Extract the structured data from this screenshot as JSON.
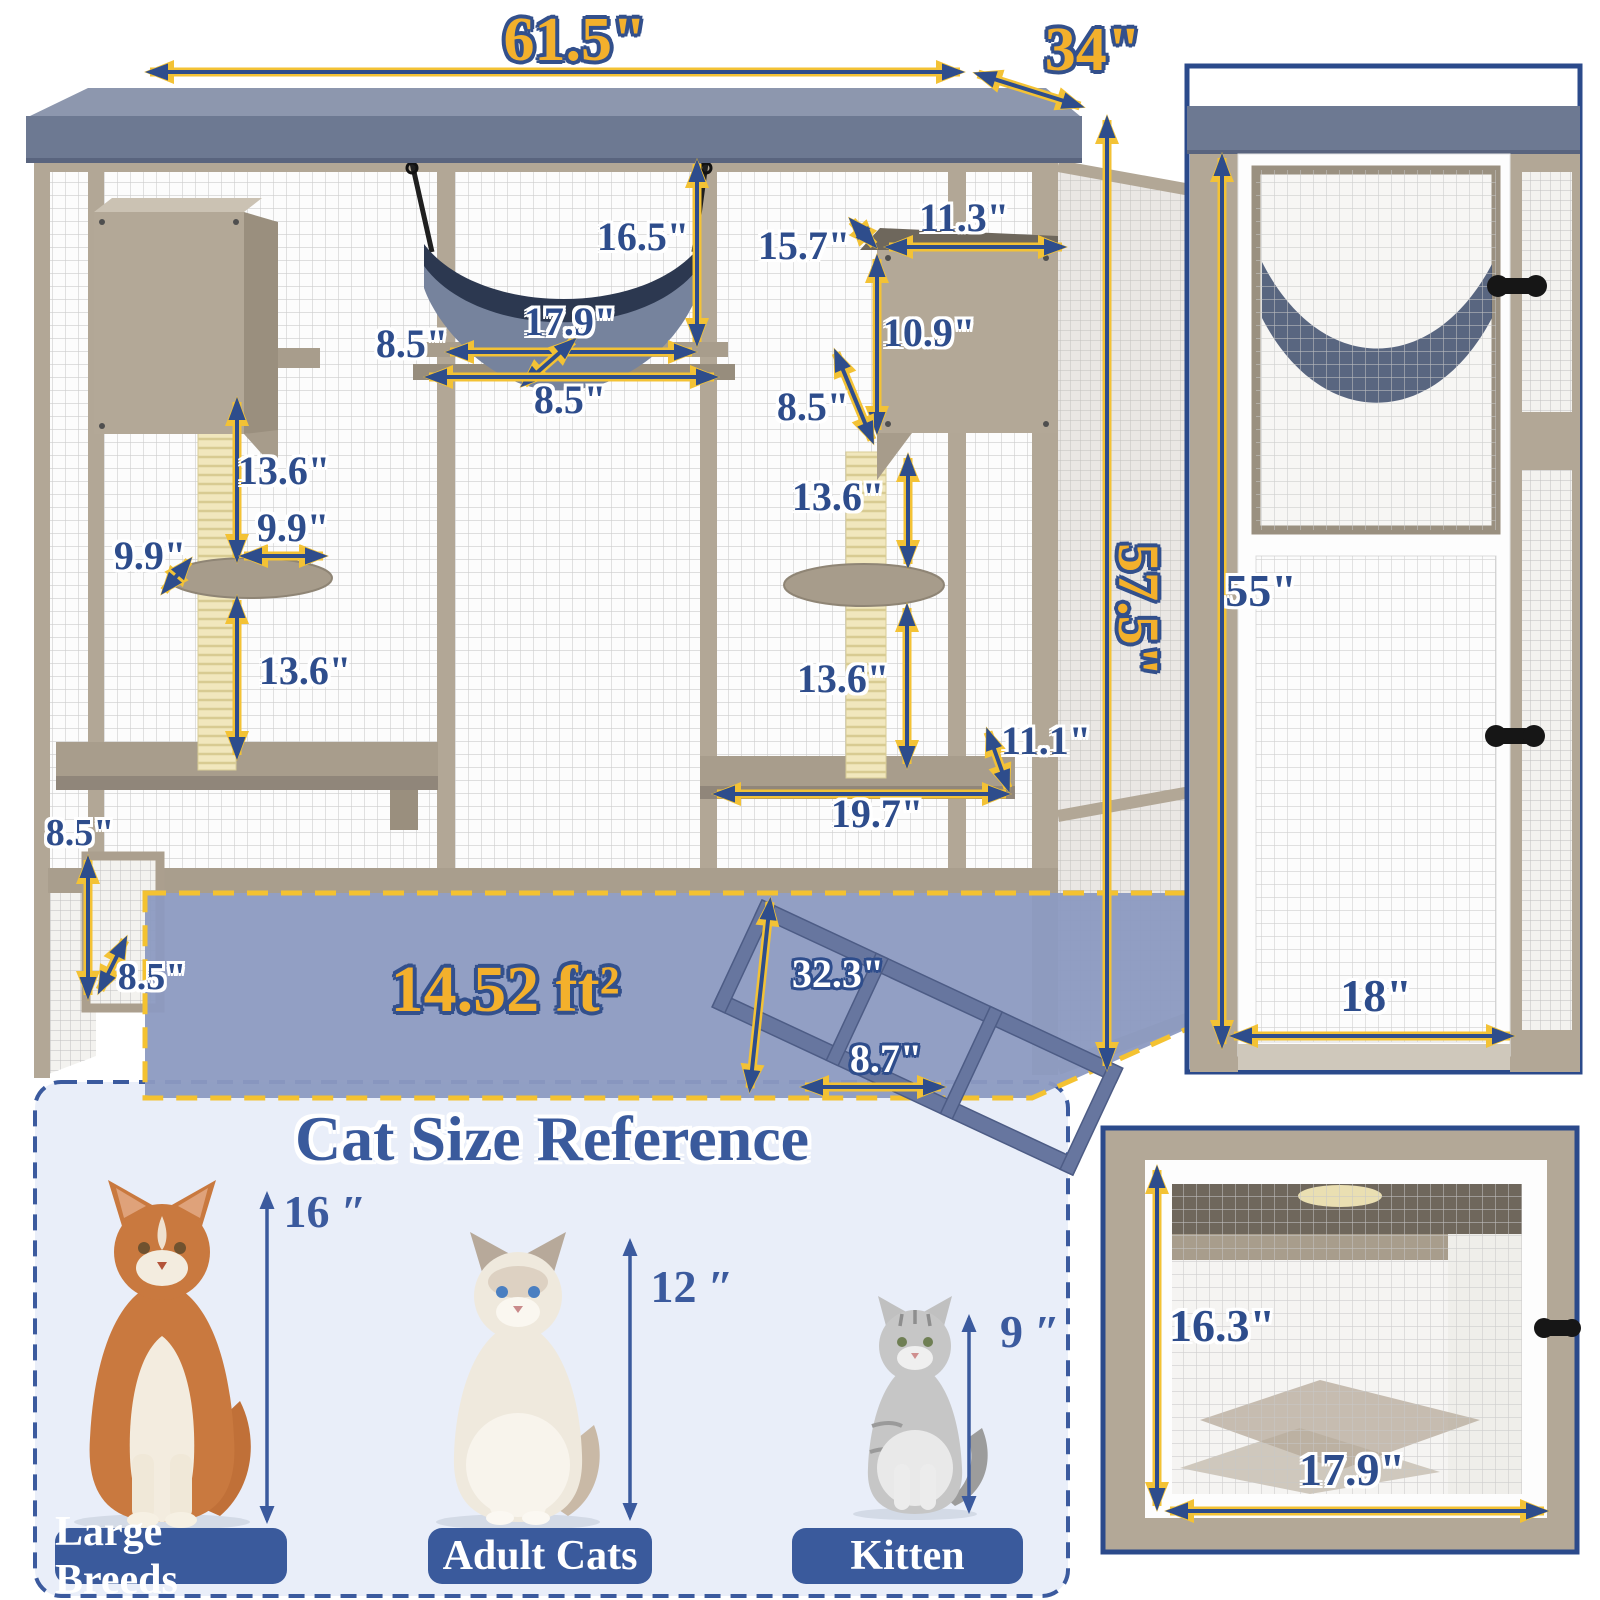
{
  "main_view": {
    "overall": {
      "width": "61.5\"",
      "depth": "34\"",
      "height": "57.5\"",
      "floor_area": "14.52 ft²"
    },
    "hammock": {
      "height_from_roof": "16.5\"",
      "width": "17.9\"",
      "shelf_depth": "8.5\"",
      "shelf_width": "8.5\""
    },
    "right_box": {
      "depth": "15.7\"",
      "width": "11.3\"",
      "height": "10.9\"",
      "shelf_depth": "8.5\""
    },
    "left_tree": {
      "upper_post": "13.6\"",
      "platform_width": "9.9\"",
      "platform_depth": "9.9\"",
      "lower_post": "13.6\""
    },
    "right_tree": {
      "upper_post": "13.6\"",
      "lower_post": "13.6\""
    },
    "bottom_shelf": {
      "depth": "11.1\"",
      "width": "19.7\""
    },
    "left_door": {
      "height": "8.5\"",
      "width": "8.5\""
    },
    "ramp": {
      "length": "32.3\"",
      "width": "8.7\""
    }
  },
  "side_view": {
    "height": "55\"",
    "width": "18\""
  },
  "door_view": {
    "height": "16.3\"",
    "width": "17.9\""
  },
  "cat_reference": {
    "title": "Cat Size Reference",
    "cats": [
      {
        "name": "Large Breeds",
        "height": "16 ″"
      },
      {
        "name": "Adult Cats",
        "height": "12 ″"
      },
      {
        "name": "Kitten",
        "height": "9 ″"
      }
    ]
  },
  "colors": {
    "accent_gold": "#f3b02c",
    "outline_navy": "#33508c",
    "dimension_navy": "#2e4d8c",
    "roof_slate": "#6d7992",
    "wood_beige": "#b3a897",
    "floor_blue": "#8c9ac1",
    "dashed_yellow": "#f4c231",
    "panel_lavender": "#e9eef9",
    "button_navy": "#3a5a9c"
  }
}
